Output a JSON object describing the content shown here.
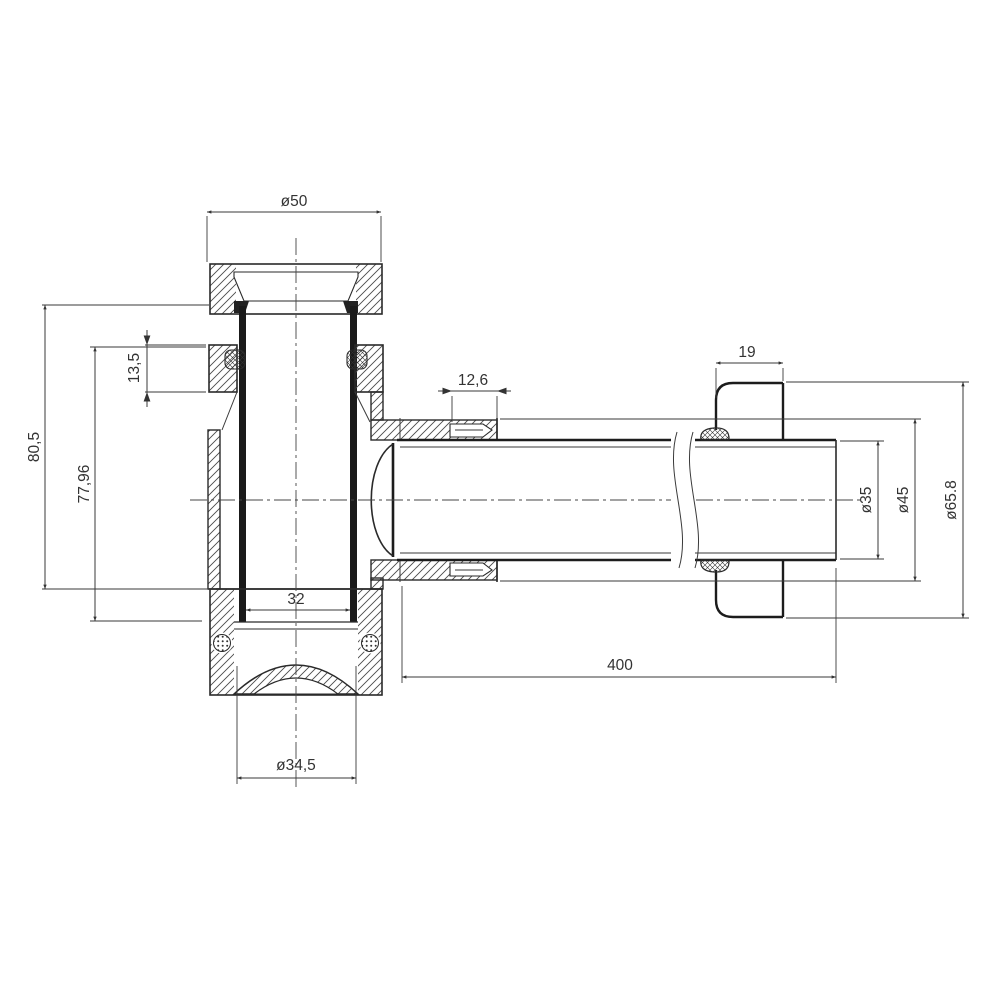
{
  "drawing": {
    "kind": "technical-section-drawing",
    "colors": {
      "background": "#ffffff",
      "line": "#2a2a2a",
      "dimension_line": "#3a3a3a",
      "text": "#333333"
    },
    "dimensions": {
      "top_diameter": {
        "label": "ø50"
      },
      "upper_seal_height": {
        "label": "13,5"
      },
      "body_height_outer": {
        "label": "80,5"
      },
      "body_height_inner": {
        "label": "77,96"
      },
      "inner_bore": {
        "label": "32"
      },
      "bottom_cap_diameter": {
        "label": "ø34,5"
      },
      "nut_section_width": {
        "label": "12,6"
      },
      "flange_depth": {
        "label": "19"
      },
      "pipe_length": {
        "label": "400"
      },
      "pipe_diameter": {
        "label": "ø35"
      },
      "nut_diameter": {
        "label": "ø45"
      },
      "flange_diameter": {
        "label": "ø65.8"
      }
    }
  }
}
